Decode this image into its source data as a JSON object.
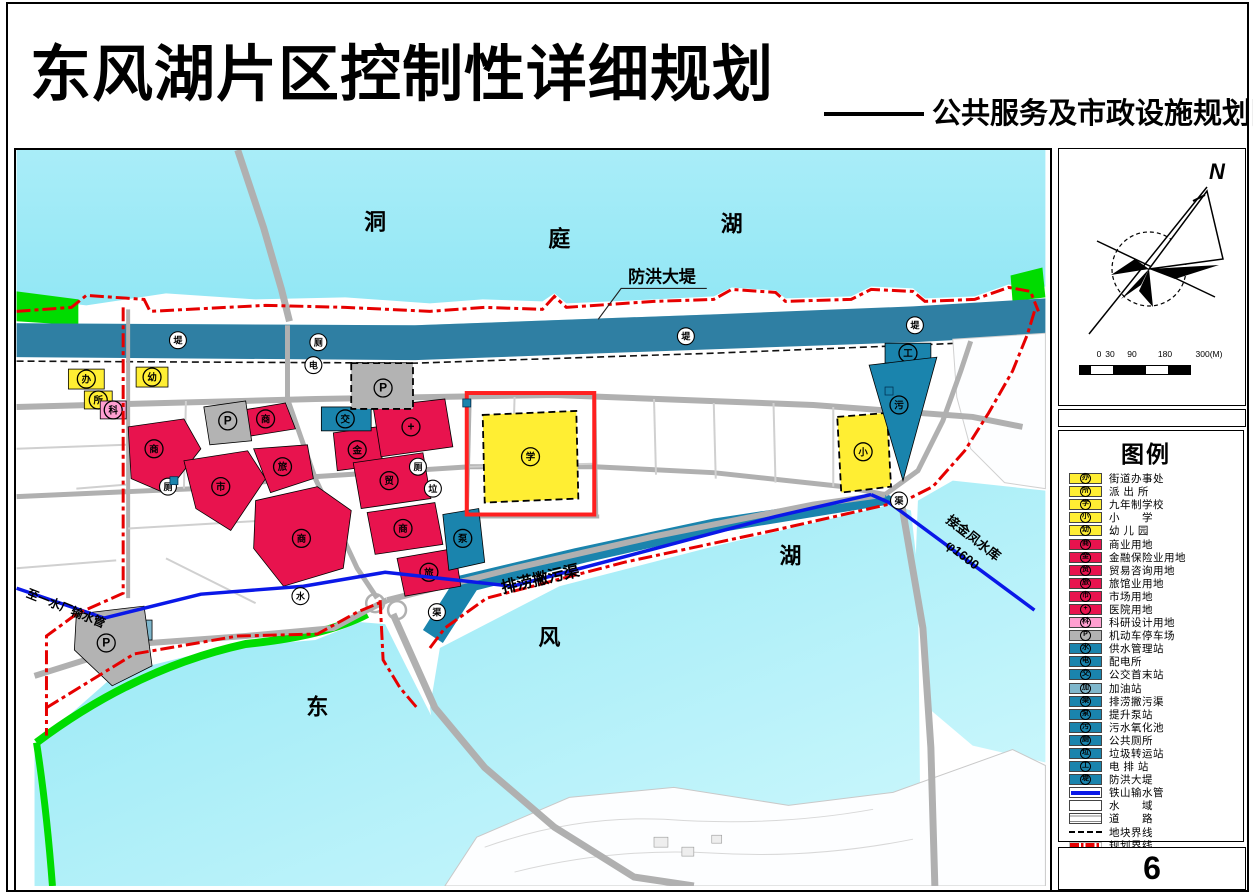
{
  "header": {
    "title": "东风湖片区控制性详细规划",
    "subtitle": "公共服务及市政设施规划图"
  },
  "sidebar": {
    "compass_label": "N",
    "scale": {
      "ticks": [
        "0",
        "30",
        "90",
        "180",
        "300(M)"
      ]
    },
    "legend": {
      "title": "图例",
      "items": [
        {
          "sym": "办",
          "swatch": "yellow",
          "label": "街道办事处"
        },
        {
          "sym": "所",
          "swatch": "yellow",
          "label": "派 出 所"
        },
        {
          "sym": "学",
          "swatch": "yellow",
          "label": "九年制学校"
        },
        {
          "sym": "小",
          "swatch": "yellow",
          "label": "小　　学"
        },
        {
          "sym": "幼",
          "swatch": "yellow",
          "label": "幼 儿 园"
        },
        {
          "sym": "商",
          "swatch": "red",
          "label": "商业用地"
        },
        {
          "sym": "金",
          "swatch": "red",
          "label": "金融保险业用地"
        },
        {
          "sym": "贸",
          "swatch": "red",
          "label": "贸易咨询用地"
        },
        {
          "sym": "旅",
          "swatch": "red",
          "label": "旅馆业用地"
        },
        {
          "sym": "市",
          "swatch": "red",
          "label": "市场用地"
        },
        {
          "sym": "+",
          "swatch": "red",
          "label": "医院用地"
        },
        {
          "sym": "科",
          "swatch": "pink",
          "label": "科研设计用地"
        },
        {
          "sym": "P",
          "swatch": "gray",
          "label": "机动车停车场"
        },
        {
          "sym": "水",
          "swatch": "teal",
          "label": "供水管理站"
        },
        {
          "sym": "电",
          "swatch": "teal",
          "label": "配电所"
        },
        {
          "sym": "交",
          "swatch": "teal",
          "label": "公交首末站"
        },
        {
          "sym": "加",
          "swatch": "tealLight",
          "label": "加油站"
        },
        {
          "sym": "渠",
          "swatch": "teal",
          "label": "排涝撇污渠"
        },
        {
          "sym": "泵",
          "swatch": "teal",
          "label": "提升泵站"
        },
        {
          "sym": "污",
          "swatch": "teal",
          "label": "污水氧化池"
        },
        {
          "sym": "厕",
          "swatch": "teal",
          "label": "公共厕所"
        },
        {
          "sym": "垃",
          "swatch": "teal",
          "label": "垃圾转运站"
        },
        {
          "sym": "工",
          "swatch": "teal",
          "label": "电 排 站"
        },
        {
          "sym": "堤",
          "swatch": "teal",
          "label": "防洪大堤"
        },
        {
          "swatch": "blueline",
          "label": "铁山输水管"
        },
        {
          "swatch": "water",
          "label": "水　　域"
        },
        {
          "swatch": "road",
          "label": "道　　路"
        },
        {
          "swatch": "blackdash",
          "label": "地块界线"
        },
        {
          "swatch": "reddash",
          "label": "规划界线"
        }
      ]
    },
    "page_number": "6"
  },
  "map": {
    "colors": {
      "yellow": "#ffee33",
      "red": "#e8134e",
      "pink": "#ff9fd0",
      "gray": "#b3b3b3",
      "teal": "#1a84ad",
      "tealLight": "#7fb7cc",
      "green": "#00dc00",
      "dike": "#2f7fa3",
      "blueLine": "#0a18e8",
      "redLine": "#e60000"
    },
    "zones": [
      {
        "sym": "办",
        "fill": "yellow",
        "x": 52,
        "y": 220,
        "w": 36,
        "h": 20,
        "m": [
          70,
          230
        ]
      },
      {
        "sym": "所",
        "fill": "yellow",
        "x": 68,
        "y": 242,
        "w": 28,
        "h": 18,
        "m": [
          82,
          251
        ]
      },
      {
        "sym": "科",
        "fill": "pink",
        "x": 84,
        "y": 252,
        "w": 26,
        "h": 18,
        "m": [
          97,
          261
        ]
      },
      {
        "sym": "幼",
        "fill": "yellow",
        "x": 120,
        "y": 218,
        "w": 32,
        "h": 20,
        "m": [
          136,
          228
        ]
      },
      {
        "sym": "学",
        "fill": "yellow",
        "dashed": true,
        "points": "468,266 562,262 564,350 470,354",
        "m": [
          516,
          308
        ]
      },
      {
        "sym": "小",
        "fill": "yellow",
        "dashed": true,
        "points": "824,268 874,264 878,338 828,344",
        "m": [
          850,
          303
        ]
      },
      {
        "sym": "商",
        "fill": "red",
        "points": "112,278 168,270 185,300 150,345 115,330",
        "m": [
          138,
          300
        ]
      },
      {
        "sym": "商",
        "fill": "red",
        "points": "222,262 270,254 280,280 230,288",
        "m": [
          250,
          270
        ]
      },
      {
        "sym": "市",
        "fill": "red",
        "points": "168,312 232,302 250,330 215,382 180,360",
        "m": [
          205,
          338
        ]
      },
      {
        "sym": "旅",
        "fill": "red",
        "points": "238,300 292,296 298,330 255,344",
        "m": [
          267,
          318
        ]
      },
      {
        "sym": "商",
        "fill": "red",
        "points": "240,352 302,338 336,362 328,420 268,438 238,400",
        "m": [
          286,
          390
        ]
      },
      {
        "sym": "金",
        "fill": "red",
        "points": "318,284 362,278 368,316 322,322",
        "m": [
          342,
          301
        ]
      },
      {
        "sym": "+",
        "fill": "red",
        "points": "358,258 430,250 438,298 366,308",
        "m": [
          396,
          278
        ]
      },
      {
        "sym": "贸",
        "fill": "red",
        "points": "338,314 408,304 416,350 346,360",
        "m": [
          374,
          332
        ]
      },
      {
        "sym": "商",
        "fill": "red",
        "points": "352,364 420,354 428,396 360,406",
        "m": [
          388,
          380
        ]
      },
      {
        "sym": "旅",
        "fill": "red",
        "points": "382,410 440,400 446,438 390,448",
        "m": [
          414,
          424
        ]
      },
      {
        "sym": "交",
        "fill": "teal",
        "x": 306,
        "y": 258,
        "w": 50,
        "h": 24,
        "m": [
          330,
          270
        ]
      },
      {
        "sym": "泵",
        "fill": "teal",
        "points": "428,366 464,360 470,414 434,422",
        "m": [
          448,
          390
        ]
      },
      {
        "sym": "工",
        "fill": "teal",
        "x": 872,
        "y": 194,
        "w": 46,
        "h": 20,
        "m": [
          895,
          204
        ]
      },
      {
        "sym": "污",
        "fill": "teal",
        "points": "856,216 924,208 890,332",
        "m": [
          886,
          256
        ]
      },
      {
        "sym": "加",
        "fill": "tealLight",
        "x": 92,
        "y": 472,
        "w": 44,
        "h": 20,
        "m": [
          114,
          482
        ]
      },
      {
        "sym": "P",
        "fill": "gray",
        "dashed": true,
        "x": 336,
        "y": 214,
        "w": 62,
        "h": 46,
        "m": [
          368,
          239
        ]
      },
      {
        "sym": "P",
        "fill": "gray",
        "points": "188,258 230,252 236,292 194,296",
        "m": [
          212,
          272
        ]
      },
      {
        "sym": "P",
        "fill": "gray",
        "points": "60,466 128,458 136,518 96,538 58,502",
        "m": [
          90,
          495
        ]
      }
    ],
    "markers": [
      {
        "sym": "电",
        "x": 298,
        "y": 216
      },
      {
        "sym": "厕",
        "x": 303,
        "y": 193
      },
      {
        "sym": "厕",
        "x": 152,
        "y": 338
      },
      {
        "sym": "厕",
        "x": 403,
        "y": 318
      },
      {
        "sym": "垃",
        "x": 418,
        "y": 340
      },
      {
        "sym": "堤",
        "x": 162,
        "y": 191
      },
      {
        "sym": "堤",
        "x": 672,
        "y": 187
      },
      {
        "sym": "堤",
        "x": 902,
        "y": 176
      },
      {
        "sym": "水",
        "x": 285,
        "y": 448
      },
      {
        "sym": "渠",
        "x": 422,
        "y": 464
      },
      {
        "sym": "渠",
        "x": 886,
        "y": 352
      }
    ],
    "squares": [
      {
        "x": 154,
        "y": 328
      },
      {
        "x": 448,
        "y": 250
      },
      {
        "x": 872,
        "y": 238
      }
    ],
    "labels": [
      {
        "t": "洞",
        "x": 360,
        "y": 80,
        "s": 22
      },
      {
        "t": "庭",
        "x": 545,
        "y": 97,
        "s": 22
      },
      {
        "t": "湖",
        "x": 718,
        "y": 82,
        "s": 22
      },
      {
        "t": "防洪大堤",
        "x": 648,
        "y": 133,
        "s": 17
      },
      {
        "t": "排涝撇污渠",
        "x": 527,
        "y": 436,
        "s": 16,
        "r": -13
      },
      {
        "t": "东",
        "x": 302,
        "y": 567,
        "s": 22
      },
      {
        "t": "风",
        "x": 535,
        "y": 497,
        "s": 22
      },
      {
        "t": "湖",
        "x": 777,
        "y": 415,
        "s": 22
      },
      {
        "t": "接金凤水库",
        "x": 958,
        "y": 393,
        "s": 13,
        "r": 38
      },
      {
        "t": "φ1600",
        "x": 947,
        "y": 410,
        "s": 13,
        "r": 38
      },
      {
        "t": "至一水厂输水管",
        "x": 48,
        "y": 464,
        "s": 12,
        "r": 22
      }
    ]
  }
}
